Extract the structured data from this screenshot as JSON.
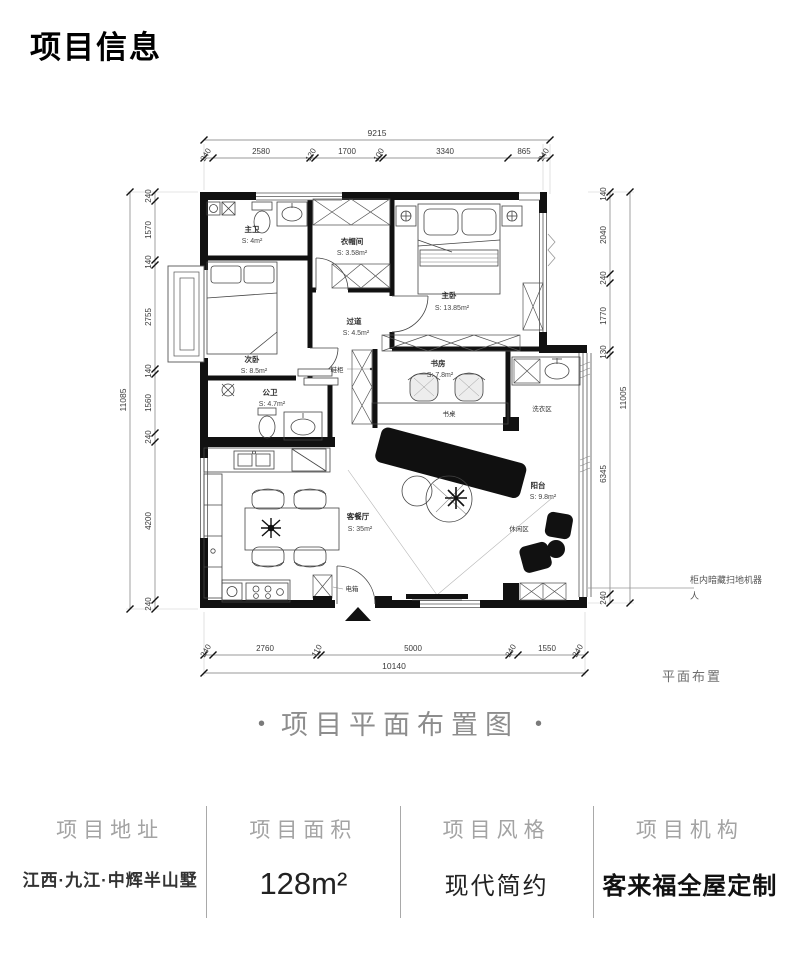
{
  "title": "项目信息",
  "caption": {
    "dot": "•",
    "text": "项目平面布置图"
  },
  "plan": {
    "corner_note": "平面布置",
    "rooms": {
      "master_bath": {
        "name": "主卫",
        "area": "S: 4m²"
      },
      "cloakroom": {
        "name": "衣帽间",
        "area": "S: 3.58m²"
      },
      "master_bedroom": {
        "name": "主卧",
        "area": "S: 13.85m²"
      },
      "second_bedroom": {
        "name": "次卧",
        "area": "S: 8.5m²"
      },
      "guest_bath": {
        "name": "公卫",
        "area": "S: 4.7m²"
      },
      "hallway": {
        "name": "过道",
        "area": "S: 4.5m²"
      },
      "study": {
        "name": "书房",
        "area": "S: 7.8m²"
      },
      "living_dining": {
        "name": "客餐厅",
        "area": "S: 35m²"
      },
      "balcony": {
        "name": "阳台",
        "area": "S: 9.8m²"
      }
    },
    "labels": {
      "desk": "书桌",
      "laundry": "洗衣区",
      "leisure": "休闲区",
      "shoe_cabinet": "鞋柜",
      "electric_box": "电箱"
    },
    "annotations": {
      "robot_line1": "柜内暗藏扫地机器",
      "robot_line2": "人"
    },
    "dims": {
      "top": {
        "total": "9215",
        "segments": [
          "240",
          "2580",
          "120",
          "1700",
          "100",
          "3340",
          "865",
          "240"
        ]
      },
      "left": {
        "total": "11085",
        "segments": [
          "240",
          "1570",
          "140",
          "2755",
          "140",
          "1560",
          "240",
          "4200",
          "240"
        ]
      },
      "right": {
        "total": "11005",
        "segments": [
          "140",
          "2040",
          "240",
          "1770",
          "130",
          "6345",
          "240"
        ]
      },
      "bottom": {
        "total": "10140",
        "segments": [
          "240",
          "2760",
          "110",
          "5000",
          "240",
          "1550",
          "240"
        ]
      }
    }
  },
  "info": {
    "columns": [
      {
        "label": "项目地址",
        "value": "江西·九江·中辉半山墅"
      },
      {
        "label": "项目面积",
        "value": "128m²"
      },
      {
        "label": "项目风格",
        "value": "现代简约"
      },
      {
        "label": "项目机构",
        "value": "客来福全屋定制"
      }
    ]
  }
}
